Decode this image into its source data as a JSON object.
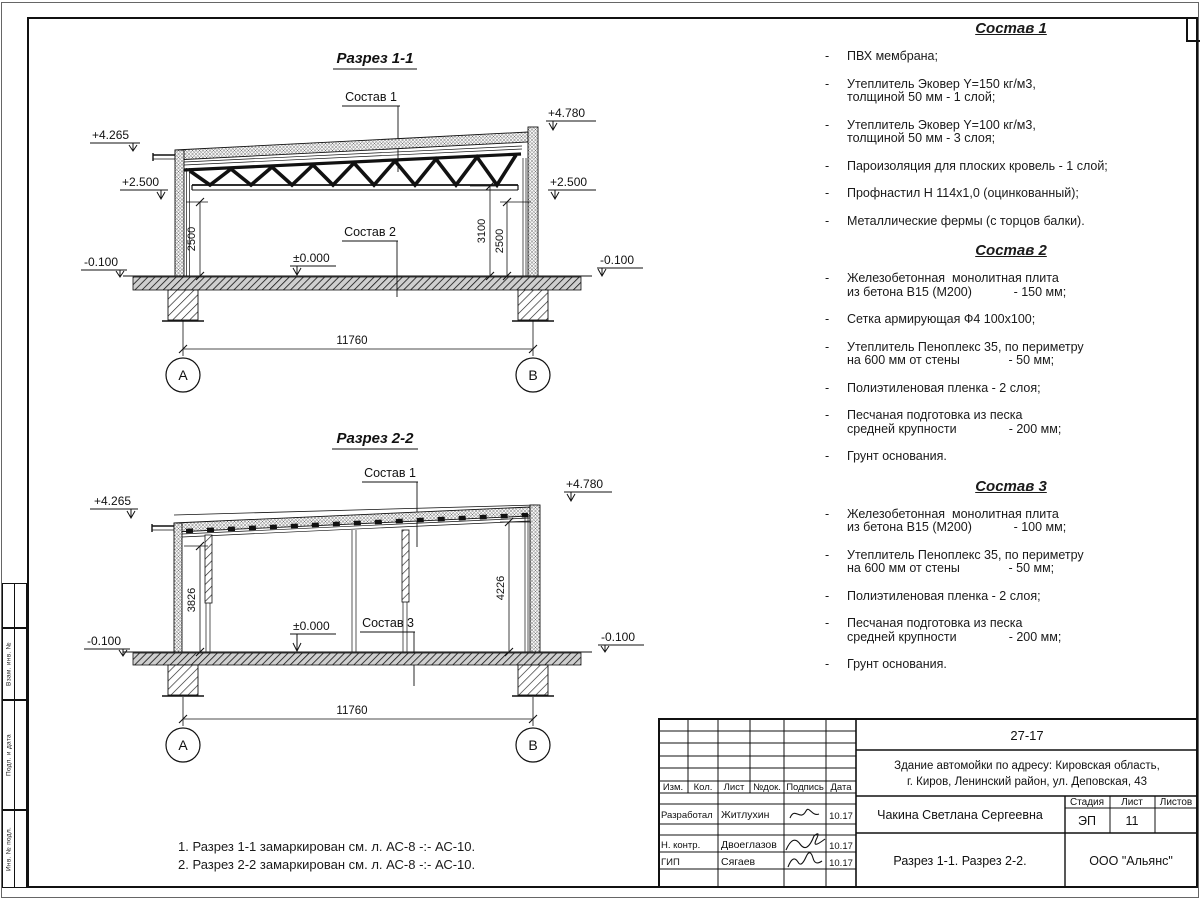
{
  "bullet": "-",
  "sections": {
    "s1": {
      "title": "Разрез 1-1",
      "leader_top": "Состав 1",
      "leader_floor": "Состав 2",
      "level_left_top": "+4.265",
      "level_left_mid": "+2.500",
      "level_left_base": "-0.100",
      "level_right_top": "+4.780",
      "level_right_mid": "+2.500",
      "level_right_base": "-0.100",
      "level_zero": "±0.000",
      "dim_left": "2500",
      "dim_right_inner": "3100",
      "dim_right_wall": "2500",
      "dim_span": "11760",
      "axis_a": "А",
      "axis_b": "В"
    },
    "s2": {
      "title": "Разрез 2-2",
      "leader_top": "Состав 1",
      "leader_floor": "Состав 3",
      "level_left_top": "+4.265",
      "level_right_top": "+4.780",
      "level_left_base": "-0.100",
      "level_right_base": "-0.100",
      "level_zero": "±0.000",
      "dim_left": "3826",
      "dim_right": "4226",
      "dim_span": "11760",
      "axis_a": "А",
      "axis_b": "В"
    }
  },
  "compositions": [
    {
      "title": "Состав 1",
      "items": [
        "ПВХ мембрана;",
        "Утеплитель Эковер Y=150 кг/м3,\nтолщиной 50 мм - 1 слой;",
        "Утеплитель Эковер Y=100 кг/м3,\nтолщиной 50 мм - 3 слоя;",
        "Пароизоляция для плоских кровель - 1 слой;",
        "Профнастил Н 114х1,0 (оцинкованный);",
        "Металлические фермы (с торцов балки)."
      ]
    },
    {
      "title": "Состав 2",
      "items": [
        "Железобетонная  монолитная плита\nиз бетона В15 (М200)            - 150 мм;",
        "Сетка армирующая Ф4 100х100;",
        "Утеплитель Пеноплекс 35, по периметру\nна 600 мм от стены              - 50 мм;",
        "Полиэтиленовая пленка - 2 слоя;",
        "Песчаная подготовка из песка\nсредней крупности               - 200 мм;",
        "Грунт основания."
      ]
    },
    {
      "title": "Состав 3",
      "items": [
        "Железобетонная  монолитная плита\nиз бетона В15 (М200)            - 100 мм;",
        "Утеплитель Пеноплекс 35, по периметру\nна 600 мм от стены              - 50 мм;",
        "Полиэтиленовая пленка - 2 слоя;",
        "Песчаная подготовка из песка\nсредней крупности               - 200 мм;",
        "Грунт основания."
      ]
    }
  ],
  "notes": {
    "line1": "1. Разрез 1-1 замаркирован см. л. АС-8 -:- АС-10.",
    "line2": "2. Разрез 2-2 замаркирован см. л. АС-8 -:- АС-10."
  },
  "left_strip": {
    "box1": "Взам. инв. №",
    "box2": "Подп. и дата",
    "box3": "Инв. № подл."
  },
  "titleblock": {
    "project_code": "27-17",
    "address_line1": "Здание автомойки по адресу: Кировская область,",
    "address_line2": "г. Киров, Ленинский район, ул. Деповская, 43",
    "header_cols": [
      "Изм.",
      "Кол.",
      "Лист",
      "№док.",
      "Подпись",
      "Дата"
    ],
    "rows": [
      {
        "role": "Разработал",
        "name": "Житлухин",
        "date": "10.17"
      },
      {
        "role": "Н. контр.",
        "name": "Двоеглазов",
        "date": "10.17"
      },
      {
        "role": "ГИП",
        "name": "Сягаев",
        "date": "10.17"
      }
    ],
    "author": "Чакина Светлана Сергеевна",
    "stage_label": "Стадия",
    "sheet_label": "Лист",
    "sheets_label": "Листов",
    "stage": "ЭП",
    "sheet_no": "11",
    "sheets_total": "",
    "doc_title": "Разрез 1-1. Разрез 2-2.",
    "company": "ООО \"Альянс\""
  }
}
